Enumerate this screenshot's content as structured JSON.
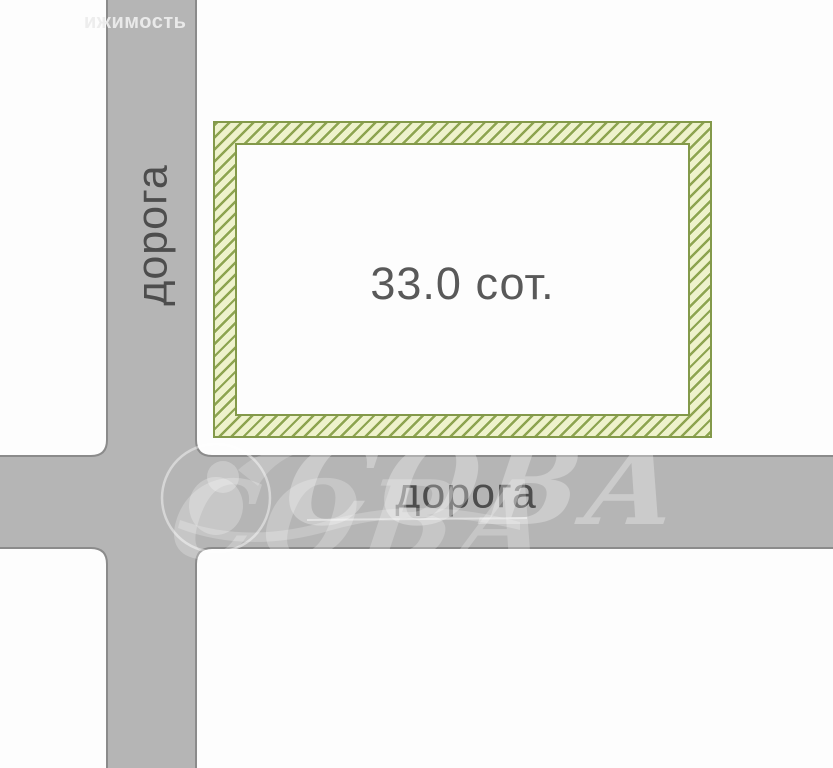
{
  "scheme": {
    "area_label": "33.0 сот.",
    "road_vertical_label": "дорога",
    "road_horizontal_label": "дорога"
  },
  "watermark": {
    "clipped_text": "ижимость",
    "brand_text": "СОВА"
  },
  "colors": {
    "paper": "#fdfdfd",
    "road-fill": "#b5b5b5",
    "road-border": "#8b8b8b",
    "hatch-bg": "#eef2cc",
    "hatch-line": "#8da450",
    "hatch-outline": "#83994a",
    "label-dark": "#4d4d4d",
    "area-text": "#595959"
  }
}
